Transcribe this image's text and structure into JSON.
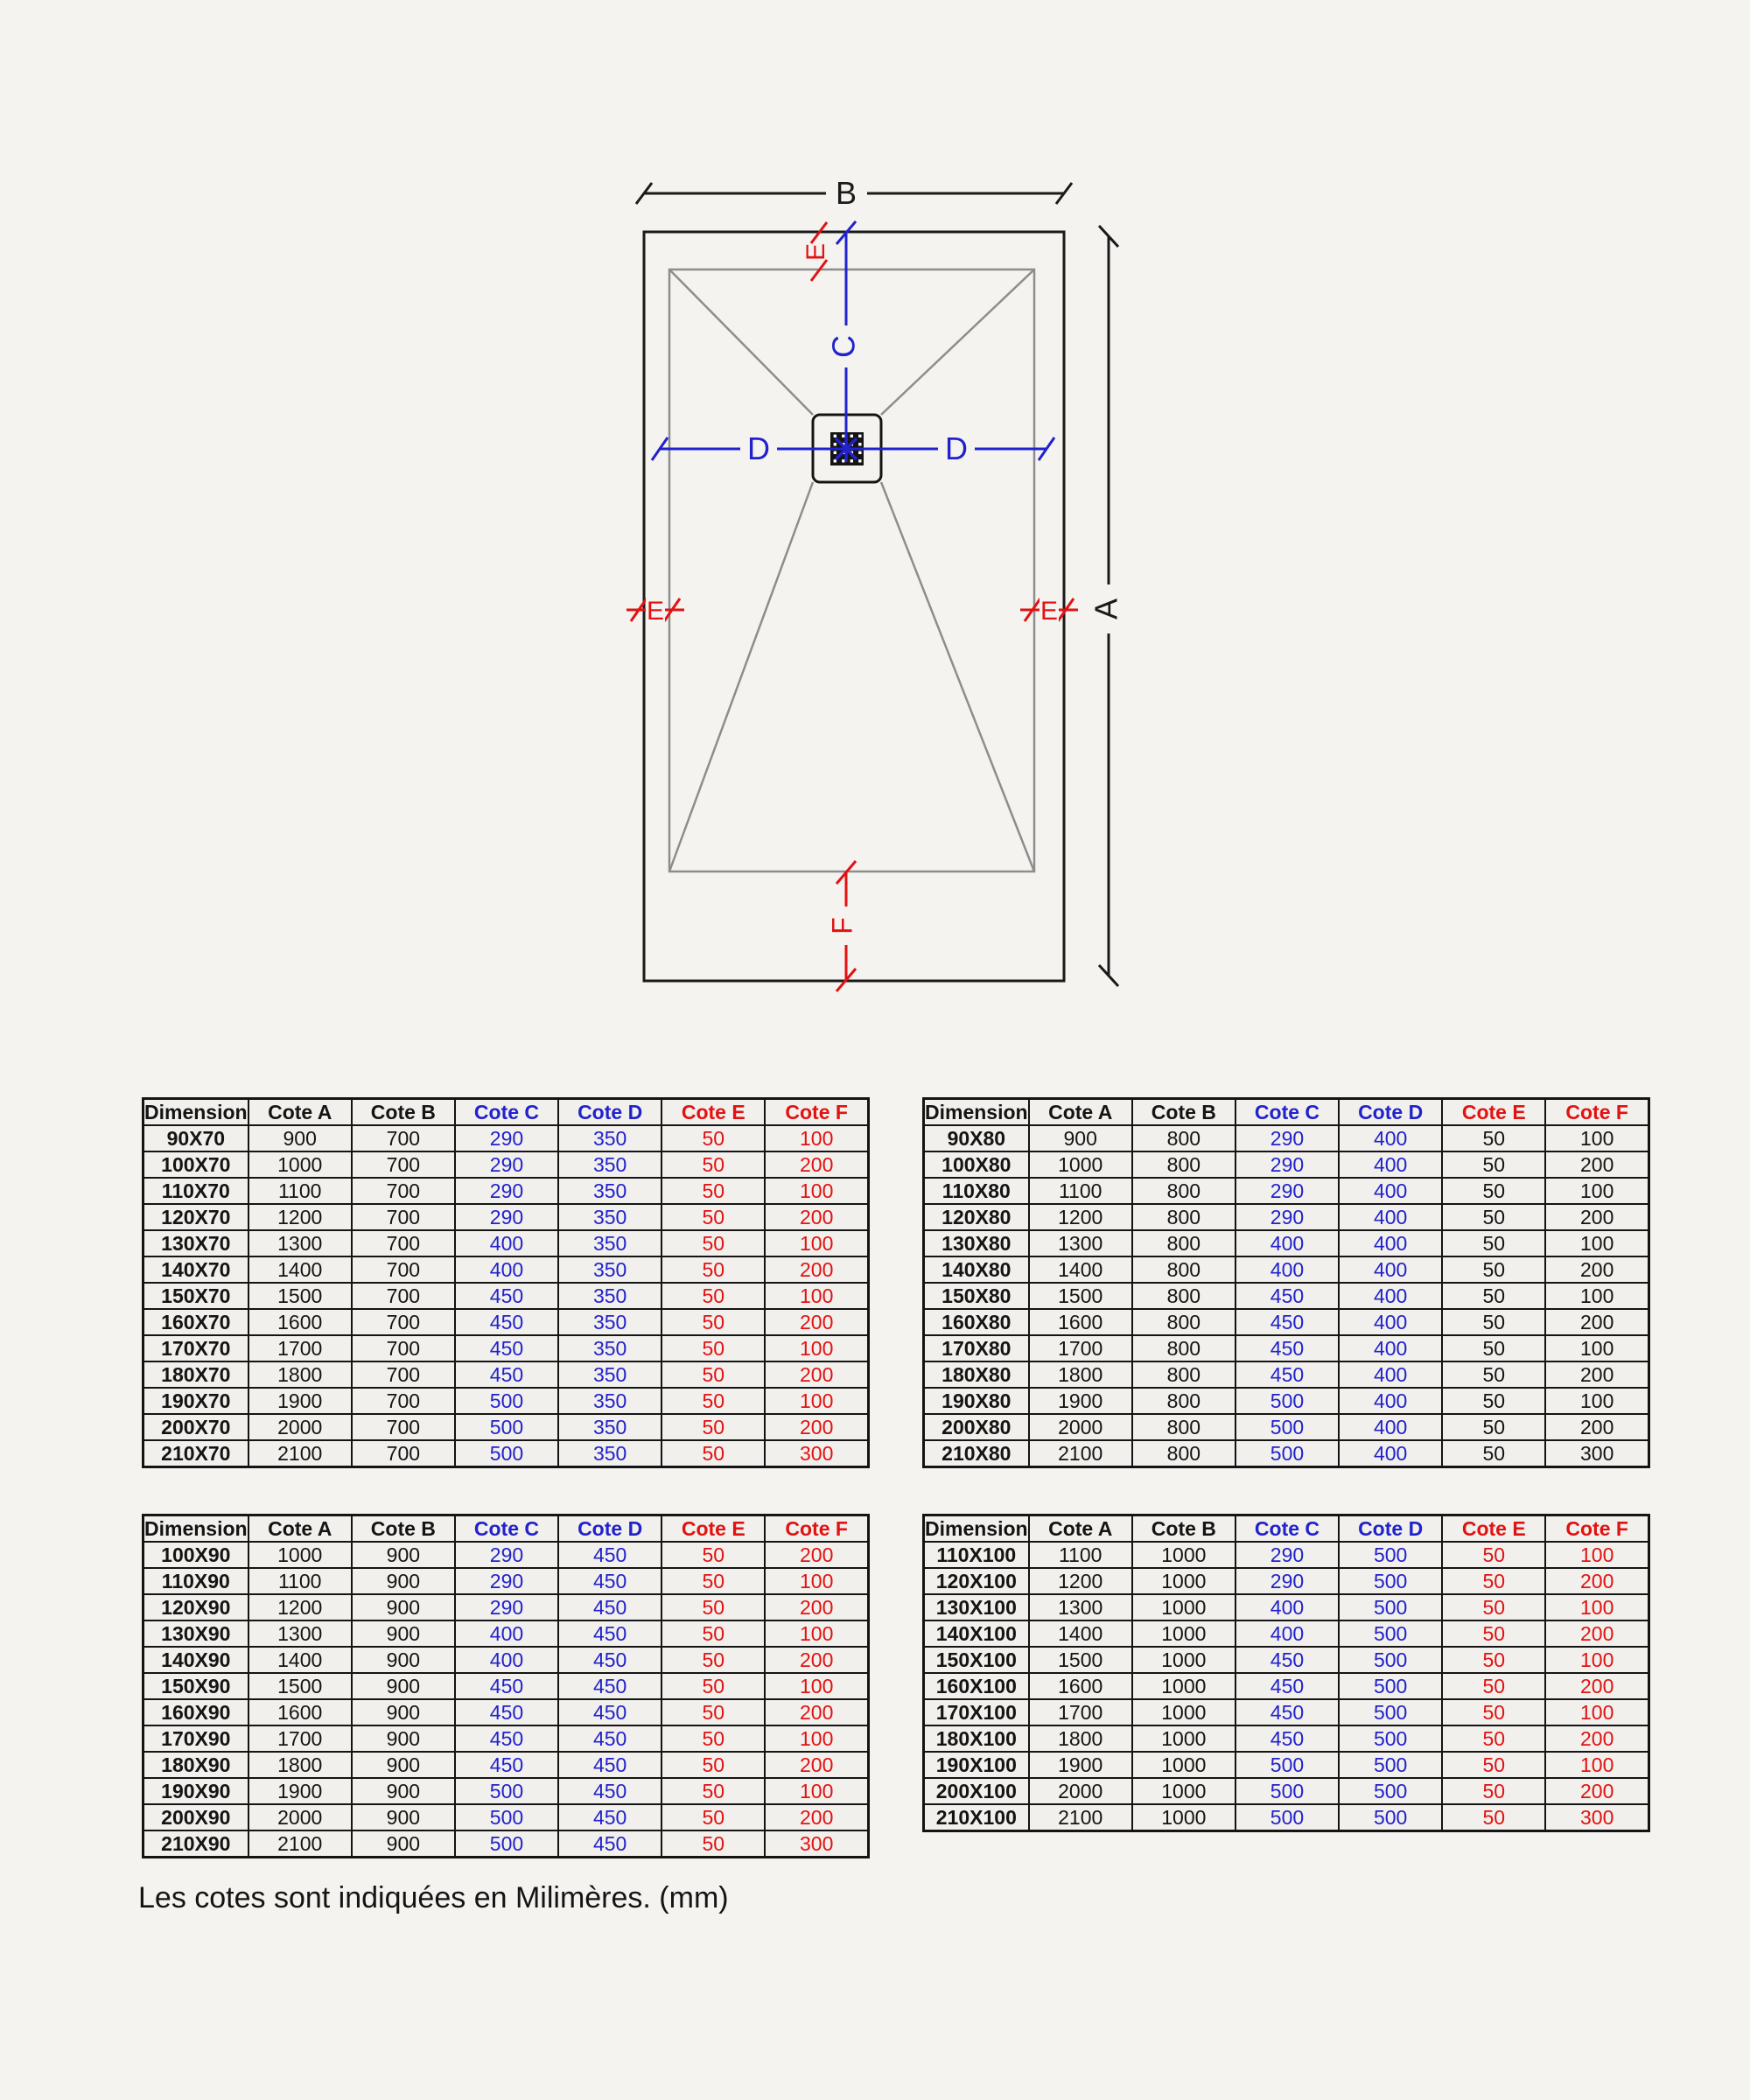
{
  "diagram": {
    "labels": {
      "a": "A",
      "b": "B",
      "c": "C",
      "d": "D",
      "e": "E",
      "f": "F"
    }
  },
  "colors": {
    "background": "#f4f3f0",
    "line_black": "#1a1a1a",
    "line_gray": "#8d8d8d",
    "dim_blue": "#2222cc",
    "dim_red": "#e11212"
  },
  "tables": [
    {
      "id": "x70",
      "headers": [
        "Dimensions",
        "Cote A",
        "Cote B",
        "Cote C",
        "Cote D",
        "Cote E",
        "Cote F"
      ],
      "header_colors": [
        "black",
        "black",
        "black",
        "blue",
        "blue",
        "red",
        "red"
      ],
      "value_colors": [
        "black",
        "black",
        "black",
        "blue",
        "blue",
        "red",
        "red"
      ],
      "rows": [
        [
          "90X70",
          "900",
          "700",
          "290",
          "350",
          "50",
          "100"
        ],
        [
          "100X70",
          "1000",
          "700",
          "290",
          "350",
          "50",
          "200"
        ],
        [
          "110X70",
          "1100",
          "700",
          "290",
          "350",
          "50",
          "100"
        ],
        [
          "120X70",
          "1200",
          "700",
          "290",
          "350",
          "50",
          "200"
        ],
        [
          "130X70",
          "1300",
          "700",
          "400",
          "350",
          "50",
          "100"
        ],
        [
          "140X70",
          "1400",
          "700",
          "400",
          "350",
          "50",
          "200"
        ],
        [
          "150X70",
          "1500",
          "700",
          "450",
          "350",
          "50",
          "100"
        ],
        [
          "160X70",
          "1600",
          "700",
          "450",
          "350",
          "50",
          "200"
        ],
        [
          "170X70",
          "1700",
          "700",
          "450",
          "350",
          "50",
          "100"
        ],
        [
          "180X70",
          "1800",
          "700",
          "450",
          "350",
          "50",
          "200"
        ],
        [
          "190X70",
          "1900",
          "700",
          "500",
          "350",
          "50",
          "100"
        ],
        [
          "200X70",
          "2000",
          "700",
          "500",
          "350",
          "50",
          "200"
        ],
        [
          "210X70",
          "2100",
          "700",
          "500",
          "350",
          "50",
          "300"
        ]
      ]
    },
    {
      "id": "x80",
      "headers": [
        "Dimensions",
        "Cote A",
        "Cote B",
        "Cote C",
        "Cote D",
        "Cote E",
        "Cote F"
      ],
      "header_colors": [
        "black",
        "black",
        "black",
        "blue",
        "blue",
        "red",
        "red"
      ],
      "value_colors": [
        "black",
        "black",
        "black",
        "blue",
        "blue",
        "black",
        "black"
      ],
      "rows": [
        [
          "90X80",
          "900",
          "800",
          "290",
          "400",
          "50",
          "100"
        ],
        [
          "100X80",
          "1000",
          "800",
          "290",
          "400",
          "50",
          "200"
        ],
        [
          "110X80",
          "1100",
          "800",
          "290",
          "400",
          "50",
          "100"
        ],
        [
          "120X80",
          "1200",
          "800",
          "290",
          "400",
          "50",
          "200"
        ],
        [
          "130X80",
          "1300",
          "800",
          "400",
          "400",
          "50",
          "100"
        ],
        [
          "140X80",
          "1400",
          "800",
          "400",
          "400",
          "50",
          "200"
        ],
        [
          "150X80",
          "1500",
          "800",
          "450",
          "400",
          "50",
          "100"
        ],
        [
          "160X80",
          "1600",
          "800",
          "450",
          "400",
          "50",
          "200"
        ],
        [
          "170X80",
          "1700",
          "800",
          "450",
          "400",
          "50",
          "100"
        ],
        [
          "180X80",
          "1800",
          "800",
          "450",
          "400",
          "50",
          "200"
        ],
        [
          "190X80",
          "1900",
          "800",
          "500",
          "400",
          "50",
          "100"
        ],
        [
          "200X80",
          "2000",
          "800",
          "500",
          "400",
          "50",
          "200"
        ],
        [
          "210X80",
          "2100",
          "800",
          "500",
          "400",
          "50",
          "300"
        ]
      ]
    },
    {
      "id": "x90",
      "headers": [
        "Dimensions",
        "Cote A",
        "Cote B",
        "Cote C",
        "Cote D",
        "Cote E",
        "Cote F"
      ],
      "header_colors": [
        "black",
        "black",
        "black",
        "blue",
        "blue",
        "red",
        "red"
      ],
      "value_colors": [
        "black",
        "black",
        "black",
        "blue",
        "blue",
        "red",
        "red"
      ],
      "rows": [
        [
          "100X90",
          "1000",
          "900",
          "290",
          "450",
          "50",
          "200"
        ],
        [
          "110X90",
          "1100",
          "900",
          "290",
          "450",
          "50",
          "100"
        ],
        [
          "120X90",
          "1200",
          "900",
          "290",
          "450",
          "50",
          "200"
        ],
        [
          "130X90",
          "1300",
          "900",
          "400",
          "450",
          "50",
          "100"
        ],
        [
          "140X90",
          "1400",
          "900",
          "400",
          "450",
          "50",
          "200"
        ],
        [
          "150X90",
          "1500",
          "900",
          "450",
          "450",
          "50",
          "100"
        ],
        [
          "160X90",
          "1600",
          "900",
          "450",
          "450",
          "50",
          "200"
        ],
        [
          "170X90",
          "1700",
          "900",
          "450",
          "450",
          "50",
          "100"
        ],
        [
          "180X90",
          "1800",
          "900",
          "450",
          "450",
          "50",
          "200"
        ],
        [
          "190X90",
          "1900",
          "900",
          "500",
          "450",
          "50",
          "100"
        ],
        [
          "200X90",
          "2000",
          "900",
          "500",
          "450",
          "50",
          "200"
        ],
        [
          "210X90",
          "2100",
          "900",
          "500",
          "450",
          "50",
          "300"
        ]
      ]
    },
    {
      "id": "x100",
      "headers": [
        "Dimensions",
        "Cote A",
        "Cote B",
        "Cote C",
        "Cote D",
        "Cote E",
        "Cote F"
      ],
      "header_colors": [
        "black",
        "black",
        "black",
        "blue",
        "blue",
        "red",
        "red"
      ],
      "value_colors": [
        "black",
        "black",
        "black",
        "blue",
        "blue",
        "red",
        "red"
      ],
      "rows": [
        [
          "110X100",
          "1100",
          "1000",
          "290",
          "500",
          "50",
          "100"
        ],
        [
          "120X100",
          "1200",
          "1000",
          "290",
          "500",
          "50",
          "200"
        ],
        [
          "130X100",
          "1300",
          "1000",
          "400",
          "500",
          "50",
          "100"
        ],
        [
          "140X100",
          "1400",
          "1000",
          "400",
          "500",
          "50",
          "200"
        ],
        [
          "150X100",
          "1500",
          "1000",
          "450",
          "500",
          "50",
          "100"
        ],
        [
          "160X100",
          "1600",
          "1000",
          "450",
          "500",
          "50",
          "200"
        ],
        [
          "170X100",
          "1700",
          "1000",
          "450",
          "500",
          "50",
          "100"
        ],
        [
          "180X100",
          "1800",
          "1000",
          "450",
          "500",
          "50",
          "200"
        ],
        [
          "190X100",
          "1900",
          "1000",
          "500",
          "500",
          "50",
          "100"
        ],
        [
          "200X100",
          "2000",
          "1000",
          "500",
          "500",
          "50",
          "200"
        ],
        [
          "210X100",
          "2100",
          "1000",
          "500",
          "500",
          "50",
          "300"
        ]
      ]
    }
  ],
  "footer": {
    "note": "Les cotes sont indiquées en Milimères. (mm)"
  }
}
